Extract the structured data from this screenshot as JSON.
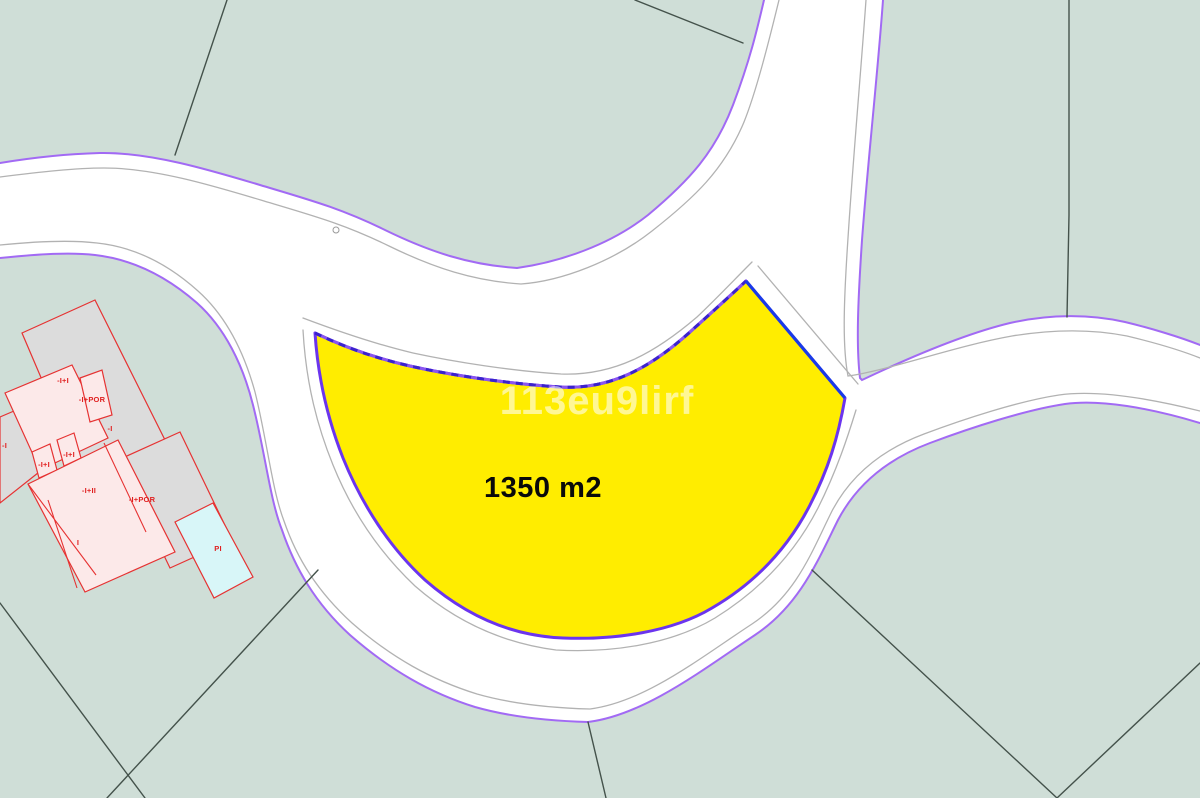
{
  "map": {
    "watermark": "113eu9lirf",
    "parcel": {
      "area_label": "1350 m2"
    },
    "building_labels": {
      "far_left": "-I",
      "upper": "-I+I",
      "upper_por": "-I+POR",
      "mid_right": "-I",
      "small_left": "-I+I",
      "small_right": "-I+I",
      "main": "-I+II",
      "main_por": "-I+POR",
      "lower": "I",
      "pool": "PI"
    },
    "colors": {
      "parcel_green": "#cfded7",
      "road_white": "#ffffff",
      "road_edge_purple": "#a26af4",
      "road_guide_gray": "#b2b2b2",
      "boundary_dark": "#44524b",
      "selected_parcel_yellow": "#ffed00",
      "selected_outline_purple": "#6b35ee",
      "selected_outline_dashed_blue": "#3a23cc",
      "selected_outline_blue": "#1a3ae8",
      "building_outline_red": "#e63232",
      "building_gray": "#dcdcdc",
      "building_pink": "#fce9e9",
      "pool_cyan": "#d8f6f8"
    }
  }
}
